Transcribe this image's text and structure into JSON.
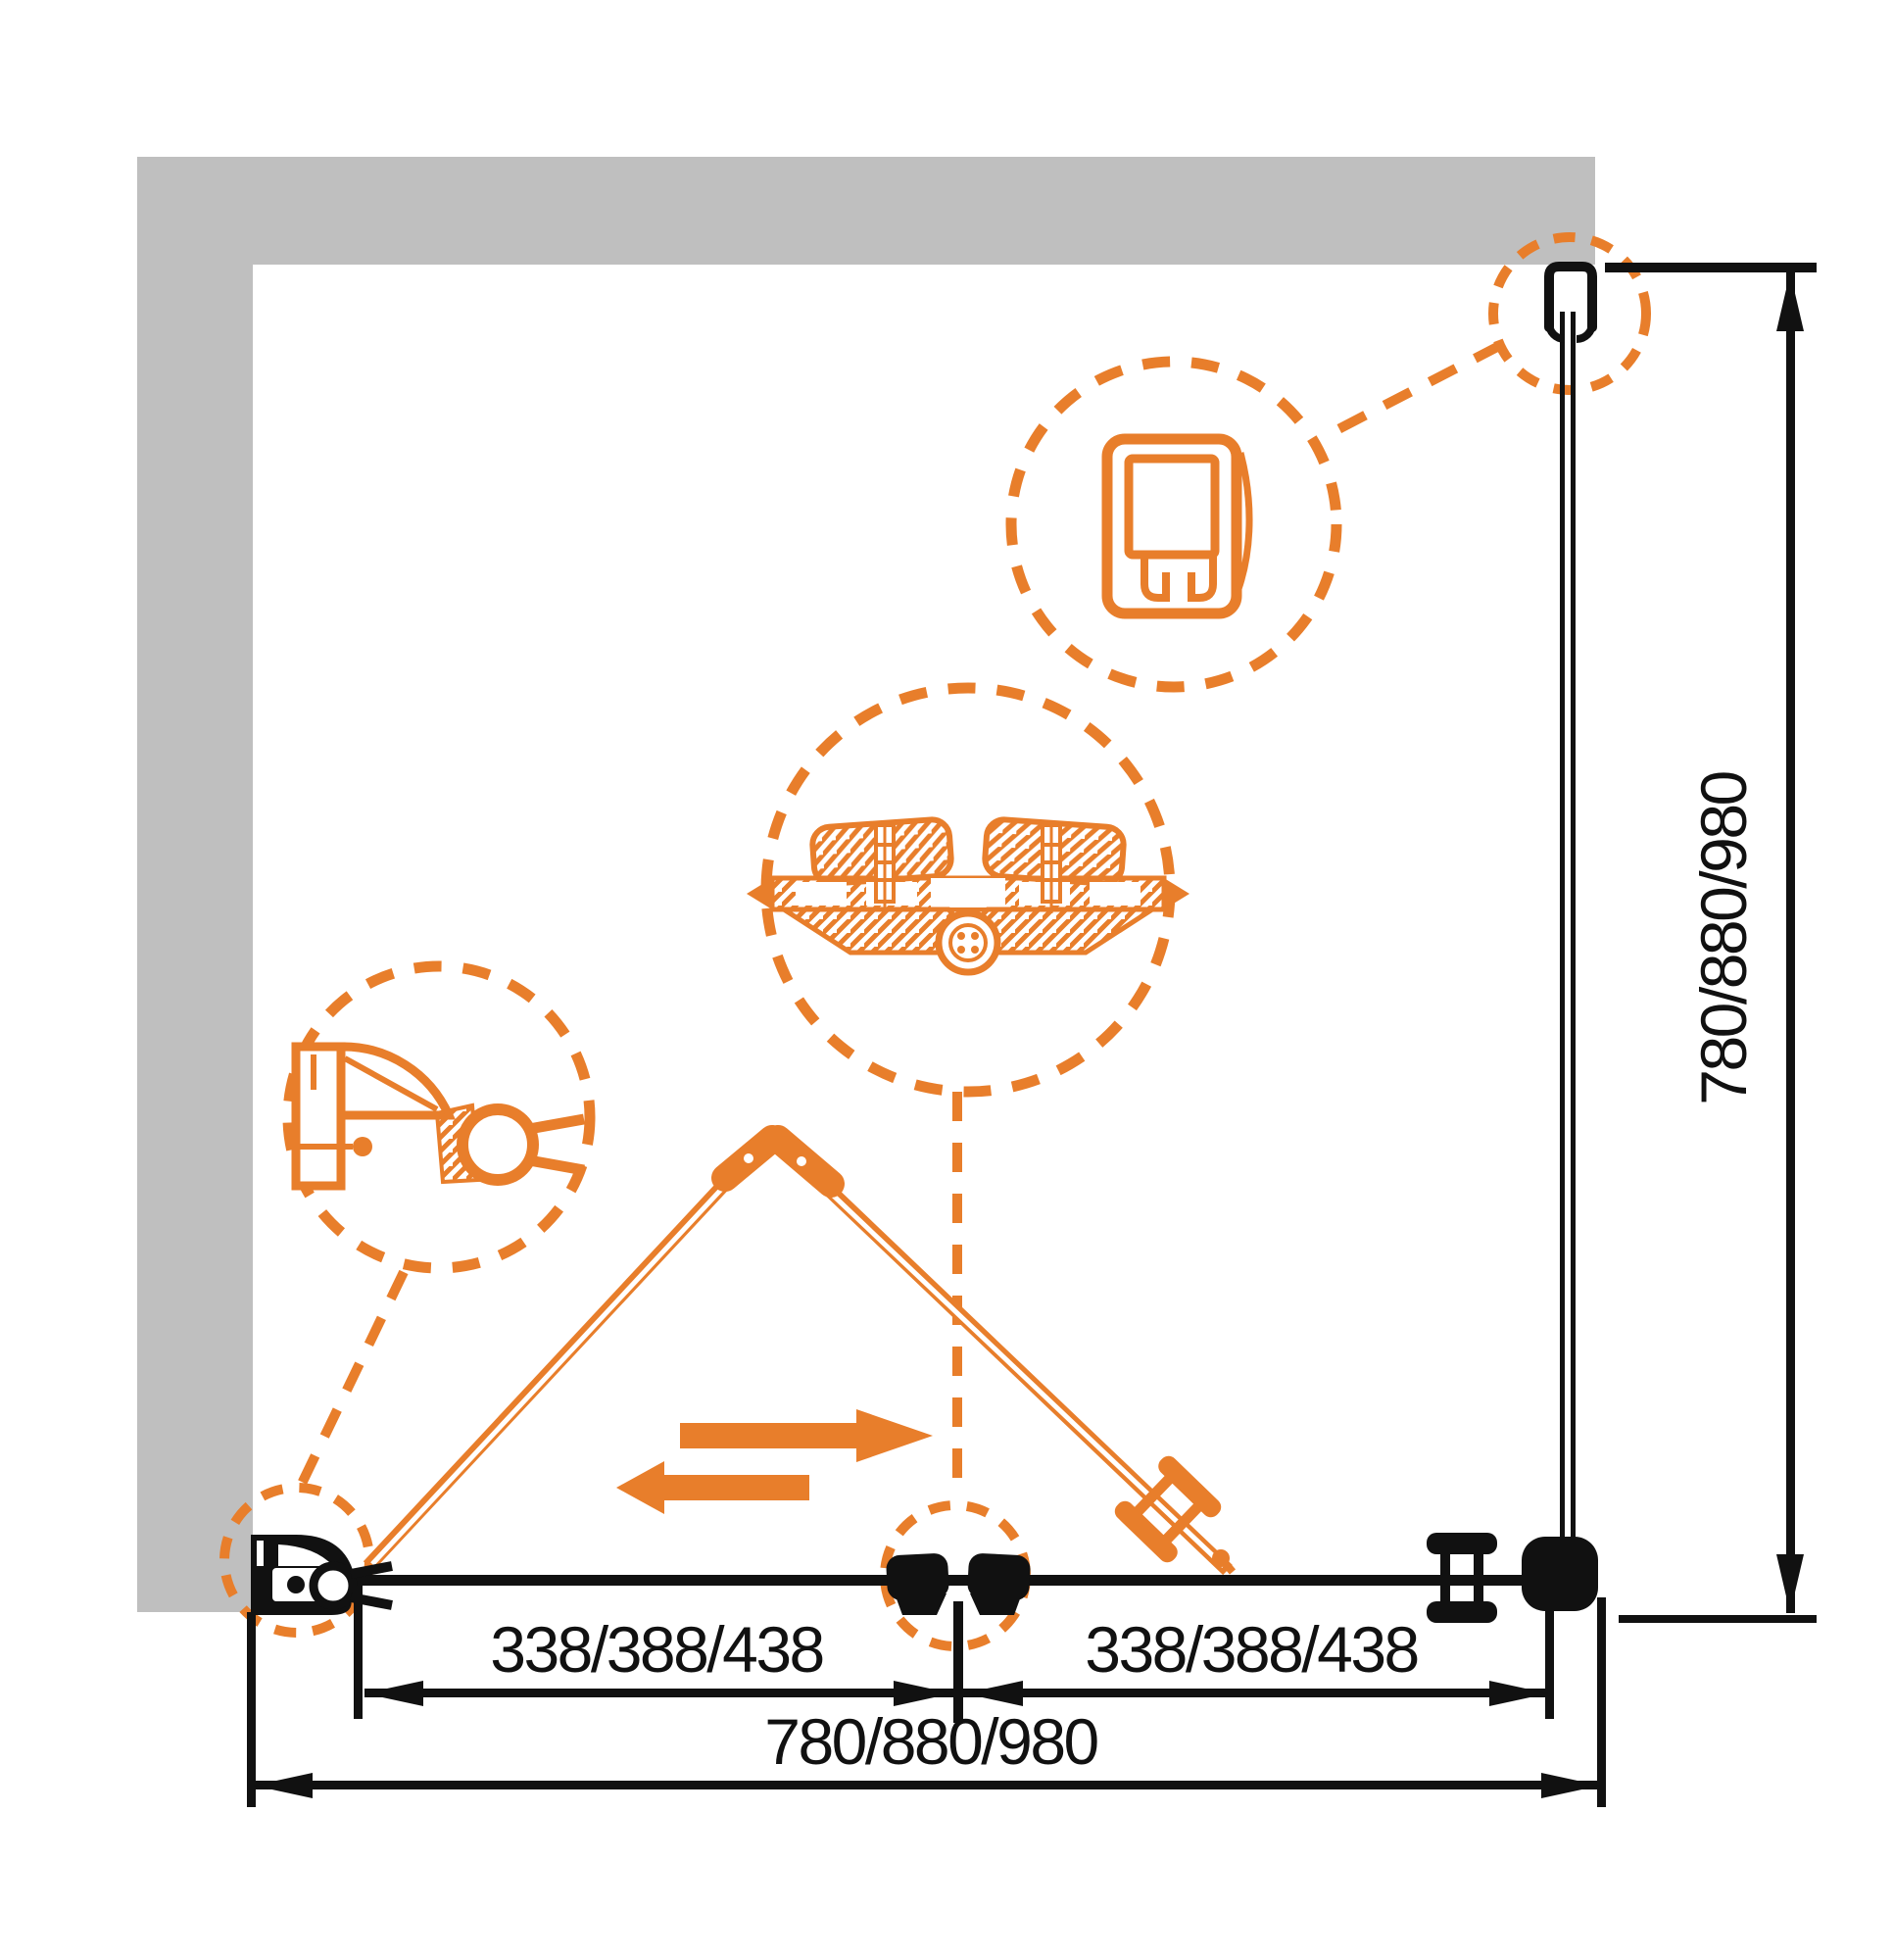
{
  "drawing": {
    "type": "shower-enclosure-installation-diagram",
    "colors": {
      "accent_orange": "#E87E2B",
      "wall_gray": "#BFBFBF",
      "line_black": "#111111",
      "background": "#FFFFFF"
    },
    "dimensions": {
      "bottom_overall": "780/880/980",
      "right_height": "780/880/980",
      "segment_left": "338/388/438",
      "segment_right": "338/388/438"
    }
  }
}
